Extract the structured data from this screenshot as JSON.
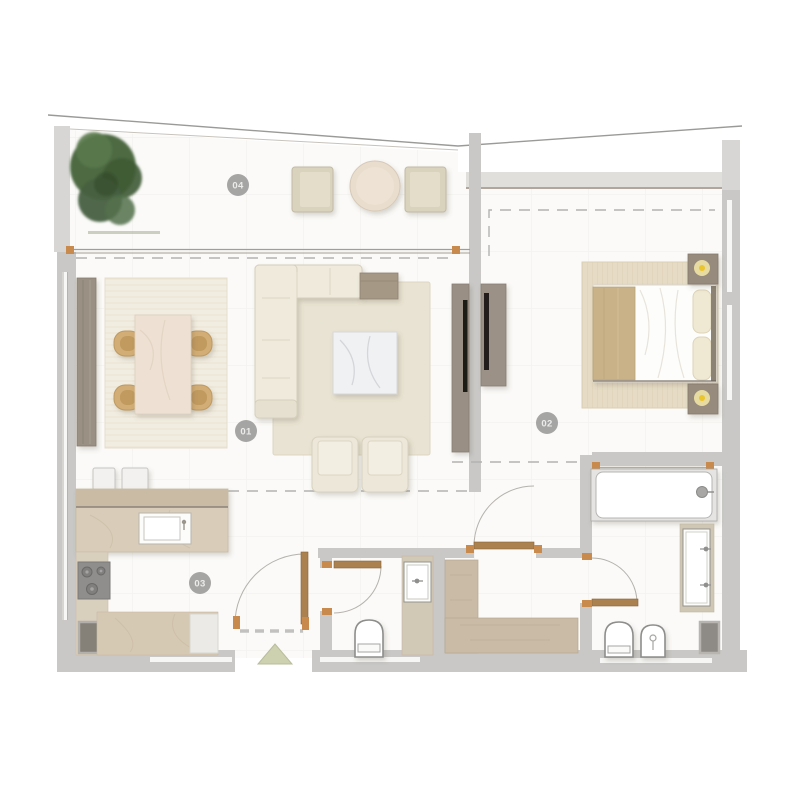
{
  "plan": {
    "type": "apartment-floor-plan",
    "rooms": {
      "living_dining": {
        "label": "01"
      },
      "bedroom": {
        "label": "02"
      },
      "kitchen": {
        "label": "03"
      },
      "balcony": {
        "label": "04"
      }
    },
    "colors": {
      "wall_gray": "#c9c8c6",
      "floor": "#fbfaf8",
      "wood_door": "#ab8150",
      "counter_beige": "#d8ccb7",
      "closet_beige": "#c9bba6",
      "rug_cream": "#eae4d4",
      "sofa_cream": "#efeadc",
      "tree_green": "#4d6a42",
      "lamp_yellow": "#eac52f",
      "label_circle": "#9d9d9c",
      "entry_arrow": "#cdd1af"
    }
  }
}
